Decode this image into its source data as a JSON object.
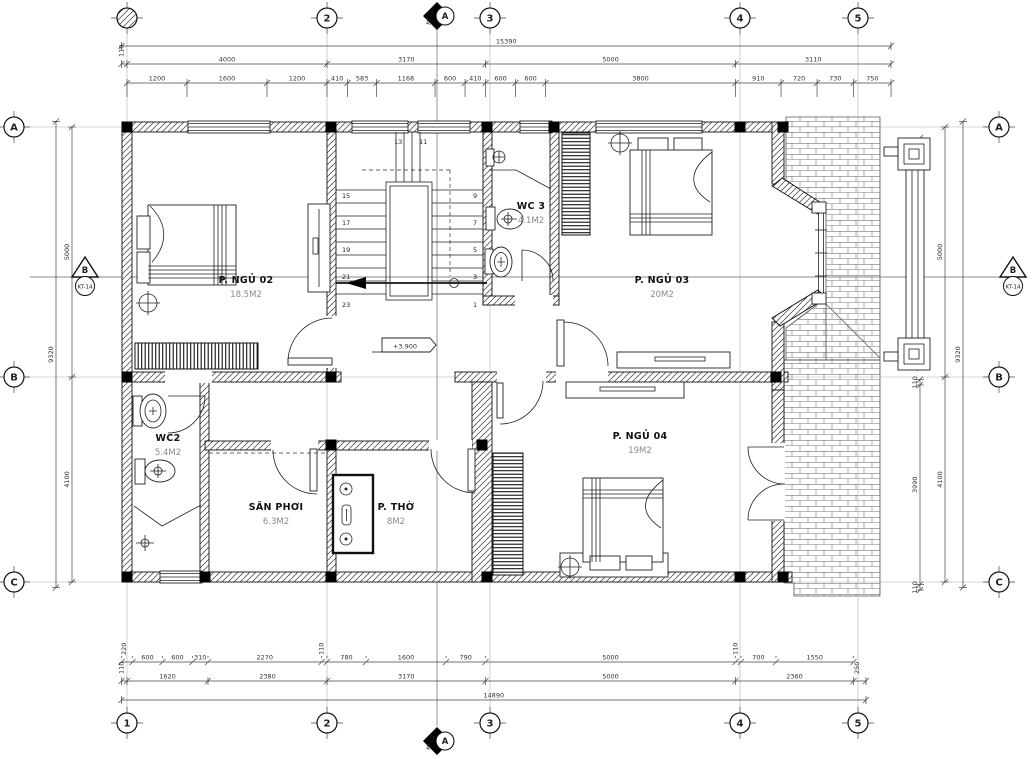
{
  "grid": {
    "cols": [
      {
        "id": "1",
        "x": 127,
        "top_style": "hatched"
      },
      {
        "id": "2",
        "x": 327
      },
      {
        "id": "3",
        "x": 490
      },
      {
        "id": "4",
        "x": 740
      },
      {
        "id": "5",
        "x": 858
      }
    ],
    "rows": [
      {
        "id": "A",
        "y": 127
      },
      {
        "id": "B",
        "y": 377
      },
      {
        "id": "C",
        "y": 582
      }
    ]
  },
  "section_markers": {
    "vertical": {
      "label": "A",
      "ref": "KT-13",
      "x": 437
    },
    "horizontal": {
      "label": "B",
      "ref": "KT-14",
      "y": 277
    }
  },
  "dimensions": {
    "top": {
      "overall": [
        "15390"
      ],
      "axis": [
        "110",
        "4000",
        "3170",
        "5000",
        "3110"
      ],
      "detail": [
        "1200",
        "1600",
        "1200",
        "410",
        "583",
        "1168",
        "600",
        "410",
        "600",
        "600",
        "3800",
        "910",
        "720",
        "730",
        "750"
      ]
    },
    "bottom": {
      "detail": [
        "220",
        "600",
        "600",
        "310",
        "2270",
        "110",
        "780",
        "1600",
        "790",
        "5000",
        "110",
        "700",
        "1550"
      ],
      "axis": [
        "110",
        "1620",
        "2380",
        "3170",
        "5000",
        "2360",
        "250"
      ],
      "overall": [
        "14890"
      ]
    },
    "left": {
      "axis": [
        "5000",
        "4100"
      ],
      "overall": [
        "9320"
      ]
    },
    "right": {
      "pergola": [
        "2300",
        "2300"
      ],
      "lower": [
        "110",
        "3990",
        "110"
      ],
      "axis": [
        "5000",
        "4100"
      ],
      "overall": [
        "9320"
      ]
    }
  },
  "rooms": [
    {
      "name": "P. NGỦ 02",
      "area": "18.5M2",
      "x": 246,
      "y": 283
    },
    {
      "name": "WC 3",
      "area": "4.1M2",
      "x": 531,
      "y": 209
    },
    {
      "name": "P. NGỦ 03",
      "area": "20M2",
      "x": 662,
      "y": 283
    },
    {
      "name": "WC2",
      "area": "5.4M2",
      "x": 168,
      "y": 441
    },
    {
      "name": "SÂN PHƠI",
      "area": "6.3M2",
      "x": 276,
      "y": 510
    },
    {
      "name": "P. THỜ",
      "area": "8M2",
      "x": 396,
      "y": 510
    },
    {
      "name": "P. NGỦ 04",
      "area": "19M2",
      "x": 640,
      "y": 439
    }
  ],
  "stairs": {
    "elevation": "+3.900",
    "numbers": [
      {
        "t": "15",
        "x": 342,
        "y": 198
      },
      {
        "t": "17",
        "x": 342,
        "y": 225
      },
      {
        "t": "19",
        "x": 342,
        "y": 252
      },
      {
        "t": "21",
        "x": 342,
        "y": 279
      },
      {
        "t": "23",
        "x": 342,
        "y": 307
      },
      {
        "t": "9",
        "x": 473,
        "y": 198
      },
      {
        "t": "7",
        "x": 473,
        "y": 225
      },
      {
        "t": "5",
        "x": 473,
        "y": 252
      },
      {
        "t": "3",
        "x": 473,
        "y": 279
      },
      {
        "t": "1",
        "x": 473,
        "y": 307
      },
      {
        "t": "13",
        "x": 394,
        "y": 144
      },
      {
        "t": "11",
        "x": 419,
        "y": 144
      }
    ]
  }
}
